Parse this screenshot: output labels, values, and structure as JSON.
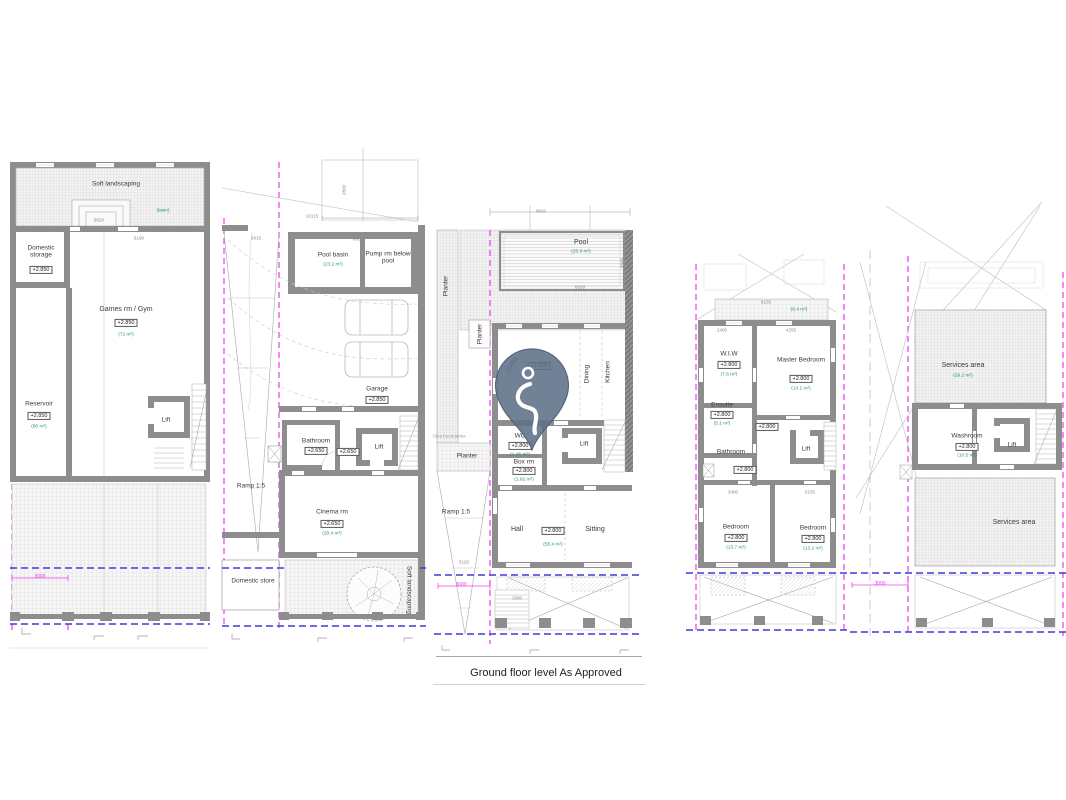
{
  "colors": {
    "wall": "#8d8d8d",
    "boundary_magenta": "#ef46ef",
    "datum_blue": "#3b3bdd",
    "area_teal": "#2a8b8b",
    "pin": "#5d7087"
  },
  "caption": "Ground floor level As Approved",
  "plan1": {
    "soft_landscaping": "Soft landscaping",
    "lawn": "(lawn)",
    "dim_top": "9620",
    "dim_games_w": "6190",
    "domestic_storage": "Domestic storage",
    "domestic_storage_level": "+2.850",
    "games": "Games rm / Gym",
    "games_level": "+2.850",
    "games_area": "(72 m²)",
    "reservoir": "Reservoir",
    "reservoir_level": "+2.850",
    "reservoir_area": "(80 m²)",
    "lift": "Lift",
    "dim_offset": "3000"
  },
  "plan2": {
    "dim_width": "10115",
    "dim_left": "3615",
    "dim_pool": "6060",
    "dim_depth": "2800",
    "pool_basin": "Pool basin",
    "pool_basin_area": "(23.2 m²)",
    "pump_rm": "Pump rm below pool",
    "garage": "Garage",
    "garage_level": "+2.850",
    "ramp": "Ramp 1:5",
    "bathroom": "Bathroom",
    "bathroom_level": "+2.650",
    "hall_level": "+2.650",
    "lift": "Lift",
    "cinema": "Cinema rm",
    "cinema_level": "+2.650",
    "cinema_area": "(20.4 m²)",
    "domestic_store": "Domestic store",
    "soft_landscaping": "Soft landscaping"
  },
  "plan3": {
    "dim_top": "9620",
    "pool": "Pool",
    "pool_area": "(26.9 m²)",
    "dim_pool_w": "6030",
    "dim_pool_h": "3500",
    "planter_left": "Planter",
    "planter_small": "Planter",
    "planter_mid": "Planter",
    "boundary_note": "Olea boundaries",
    "living": "Living",
    "living_level": "+2.800",
    "dining": "Dining",
    "kitchen": "Kitchen",
    "wc": "WC",
    "wc_level": "+2.800",
    "wc_area": "(1.45 m²)",
    "box_rm": "Box rm",
    "box_rm_level": "+2.800",
    "box_rm_area": "(1.82 m²)",
    "lift": "Lift",
    "hall": "Hall",
    "hall_level": "+2.800",
    "hall_area": "(55.4 m²)",
    "sitting": "Sitting",
    "ramp": "Ramp 1:5",
    "dim_ramp": "3120",
    "dim_offset": "3000",
    "dim_stair": "1500"
  },
  "plan4": {
    "dim_planter": "9135",
    "planter_area": "(8.4 m²)",
    "dim_wiw": "2400",
    "dim_master": "4255",
    "dim_right": "4320",
    "wiw": "W.I.W",
    "wiw_level": "+2.800",
    "wiw_area": "(7.6 m²)",
    "master": "Master Bedroom",
    "master_level": "+2.800",
    "master_area": "(14.1 m²)",
    "ensuite": "Ensuite",
    "ensuite_level": "+2.800",
    "ensuite_area": "(5.1 m²)",
    "bathroom": "Bathroom",
    "bathroom_level": "+2.800",
    "landing_level": "+2.800",
    "lift": "Lift",
    "dim_bed1": "3400",
    "dim_bed2": "5235",
    "bedroom1": "Bedroom",
    "bedroom1_level": "+2.800",
    "bedroom1_area": "(13.7 m²)",
    "bedroom2": "Bedroom",
    "bedroom2_level": "+2.800",
    "bedroom2_area": "(13.2 m²)"
  },
  "plan5": {
    "services_top": "Services area",
    "services_top_area": "(29.2 m²)",
    "washroom": "Washroom",
    "washroom_level": "+2.800",
    "washroom_area": "(10.5 m²)",
    "lift": "Lift",
    "services_bottom": "Services area",
    "dim_offset": "3000"
  }
}
